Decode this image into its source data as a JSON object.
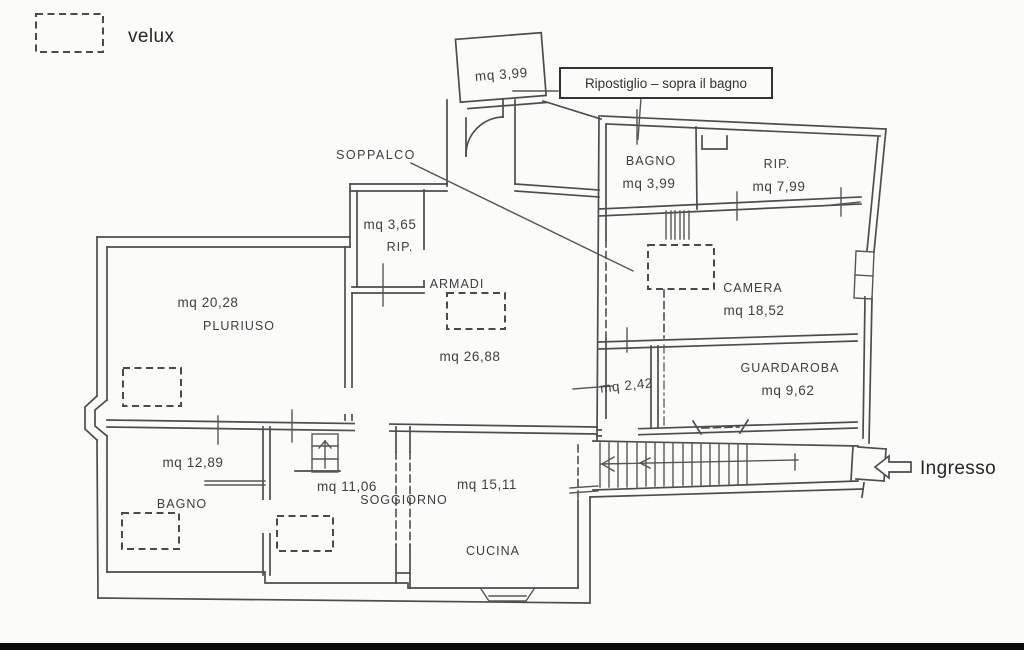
{
  "legend": {
    "velux": "velux"
  },
  "callout": {
    "ripostiglio": "Ripostiglio – sopra il bagno"
  },
  "labels": {
    "soppalco": "SOPPALCO",
    "armadi": "ARMADI",
    "ingresso": "Ingresso"
  },
  "rooms": {
    "top_room": {
      "area": "mq  3,99"
    },
    "bagno_sopra": {
      "name": "BAGNO",
      "area": "mq  3,99"
    },
    "rip_sopra": {
      "name": "RIP.",
      "area": "mq  7,99"
    },
    "rip_piccolo": {
      "name": "RIP.",
      "area": "mq  3,65"
    },
    "soppalco_room": {
      "area": "mq  26,88"
    },
    "pluriuso": {
      "name": "PLURIUSO",
      "area": "mq  20,28"
    },
    "camera": {
      "name": "CAMERA",
      "area": "mq  18,52"
    },
    "disimpegno": {
      "area": "mq  2,42"
    },
    "guardaroba": {
      "name": "GUARDAROBA",
      "area": "mq  9,62"
    },
    "bagno": {
      "name": "BAGNO",
      "area": "mq  12,89"
    },
    "soggiorno": {
      "name": "SOGGIORNO",
      "area": "mq  11,06"
    },
    "cucina": {
      "name": "CUCINA",
      "area": "mq  15,11"
    }
  },
  "colors": {
    "line": "#4d4d4d",
    "background": "#fbfbf9",
    "bottom_bar": "#0c0c0c",
    "text": "#3e3e3e"
  }
}
